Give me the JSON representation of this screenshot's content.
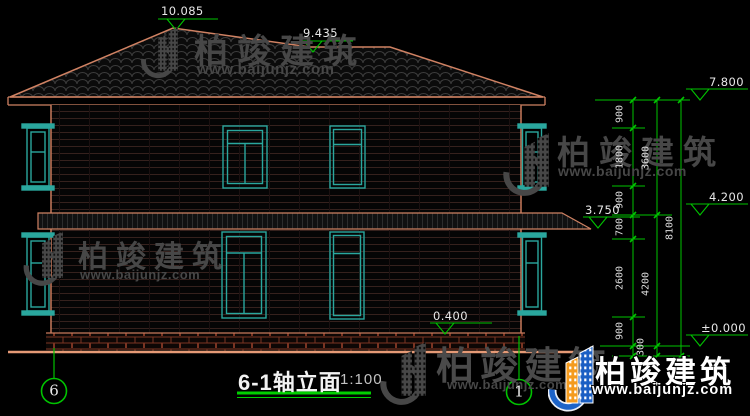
{
  "drawing": {
    "title": "6-1轴立面",
    "scale": "1:100",
    "axis_left": "6",
    "axis_right": "1"
  },
  "elevations": {
    "ridge_top": "10.085",
    "ridge_lower": "9.435",
    "eave": "7.800",
    "level2": "4.200",
    "canopy": "3.750",
    "plinth": "0.400",
    "ground": "±0.000"
  },
  "dims": {
    "col1": [
      "900",
      "1800",
      "900",
      "700",
      "2600",
      "900"
    ],
    "col2": [
      "3600",
      "4200",
      "300"
    ],
    "col3": [
      "8100"
    ]
  },
  "watermark": {
    "name": "柏竣建筑",
    "url": "www.baijunjz.com"
  },
  "colors": {
    "background": "#000000",
    "outline_salmon": "#d08263",
    "window_teal": "#2aa79e",
    "dimension_green": "#00c300",
    "text_white": "#e8e8e8",
    "watermark_gray": "#474747",
    "brand_blue": "#1c63c8",
    "brand_orange": "#f59b1e"
  }
}
